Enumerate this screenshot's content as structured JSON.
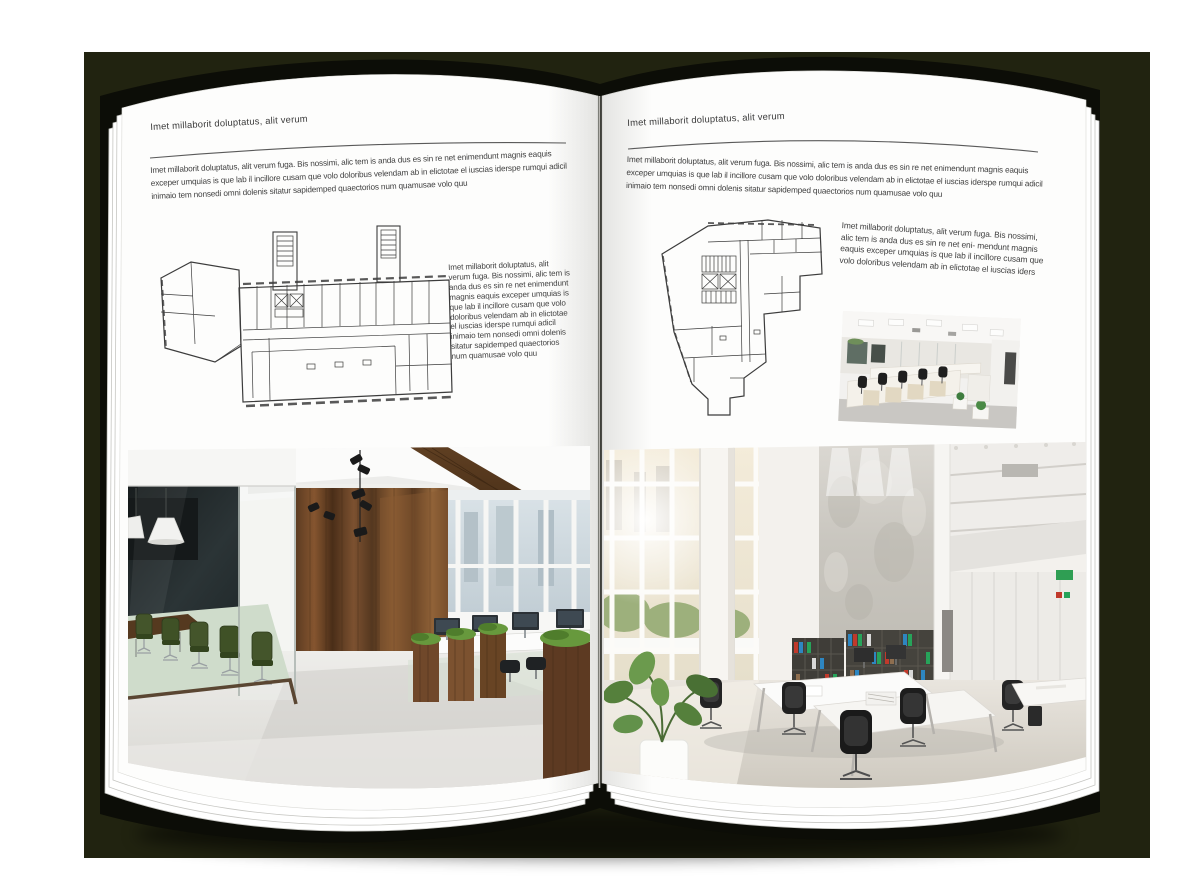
{
  "palette": {
    "backdrop": "#212310",
    "book_cover": "#0c0d07",
    "page": "#fdfdfc",
    "text": "#404040",
    "header_rule": "#5a5a5a",
    "floorplan_line": "#3c3c3c"
  },
  "left_page": {
    "header": "Imet millaborit doluptatus, alit verum",
    "intro": "Imet millaborit doluptatus, alit verum fuga. Bis nossimi, alic tem is anda dus es sin re net enimendunt magnis eaquis exceper umquias is que lab il incillore cusam que volo doloribus velendam ab in elictotae el iuscias iderspe rumqui adicil inimaio tem nonsedi omni dolenis sitatur sapidemped quaectorios num quamusae volo quu",
    "side_text": "Imet millaborit doluptatus, alit verum fuga. Bis nossimi, alic tem is anda dus es sin re net enimendunt magnis eaquis exceper umquias is que lab il incillore cusam que volo doloribus velendam ab in elictotae el iuscias iderspe rumqui adicil inimaio tem nonsedi omni dolenis sitatur sapidemped quaectorios num quamusae volo quu"
  },
  "right_page": {
    "header": "Imet millaborit doluptatus, alit verum",
    "intro": "Imet millaborit doluptatus, alit verum fuga. Bis nossimi, alic tem is anda dus es sin re net enimendunt magnis eaquis exceper umquias is que lab il incillore cusam que volo doloribus velendam ab in elictotae el iuscias iderspe rumqui adicil inimaio tem nonsedi omni dolenis sitatur sapidemped quaectorios num quamusae volo quu",
    "body_text": "Imet millaborit doluptatus, alit verum fuga. Bis nossimi, alic tem is anda dus es sin re net eni- mendunt magnis eaquis exceper umquias is que lab il incillore cusam que volo doloribus velendam ab in elictotae el iuscias iders"
  },
  "figures": {
    "left_floorplan": "architectural floor plan, wide slab building with two stair towers",
    "right_floorplan": "architectural floor plan, irregular building outline",
    "left_photo": "office interior with dark glass meeting room, green chairs and wood wall",
    "right_photo": "bright double-height office atrium with bookshelves and white desks",
    "small_photo": "open plan office with white workstation cubicles"
  }
}
